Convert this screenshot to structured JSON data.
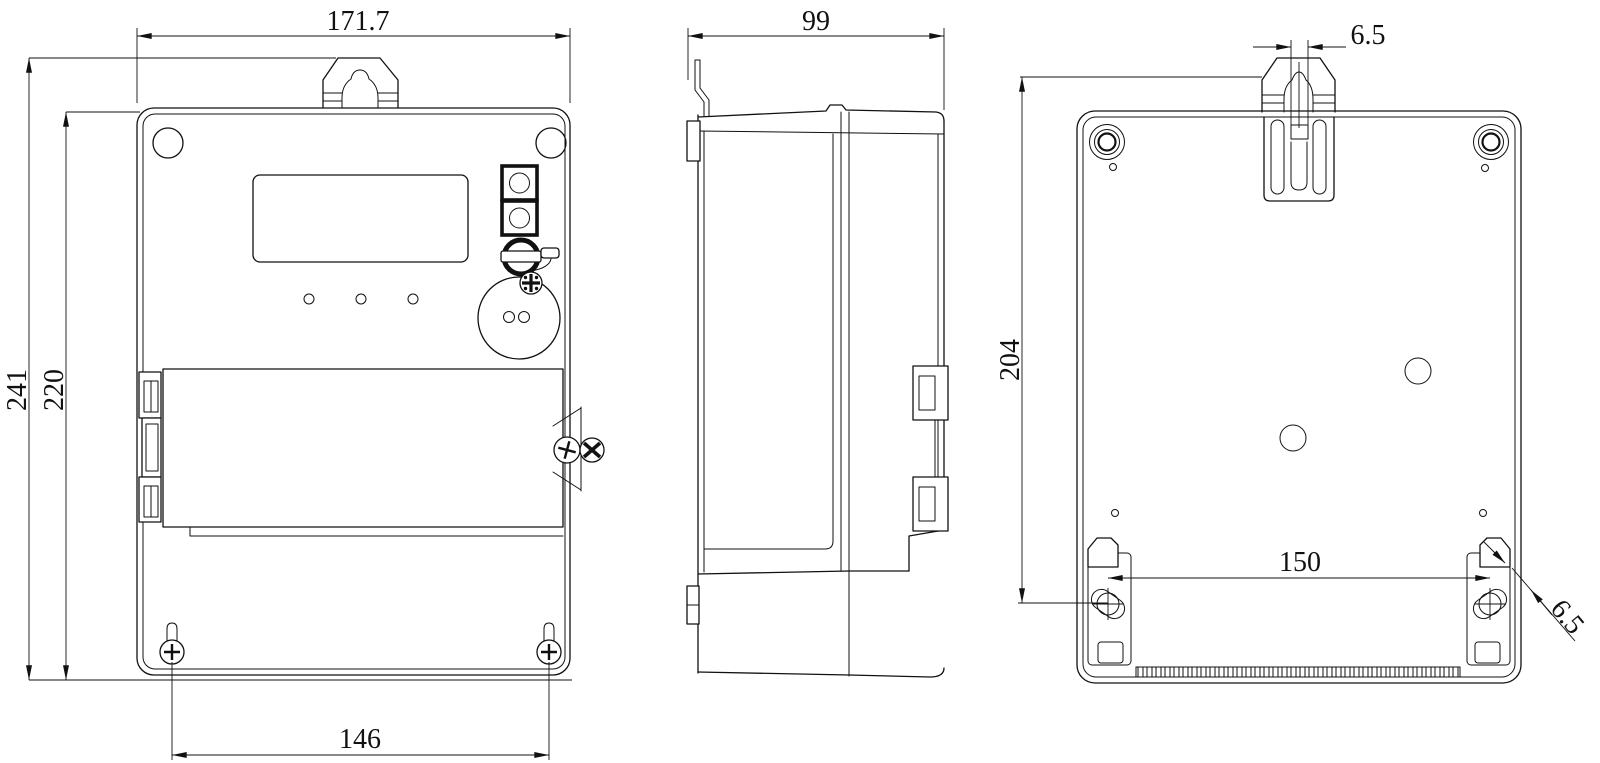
{
  "drawing": {
    "dimensions": {
      "front_width": "171.7",
      "overall_height": "241",
      "body_height": "220",
      "bottom_screw_spacing": "146",
      "depth": "99",
      "back_mounting_height": "204",
      "hook_slot_width": "6.5",
      "mounting_hole_spacing": "150",
      "mounting_slot_width": "6.5"
    }
  }
}
